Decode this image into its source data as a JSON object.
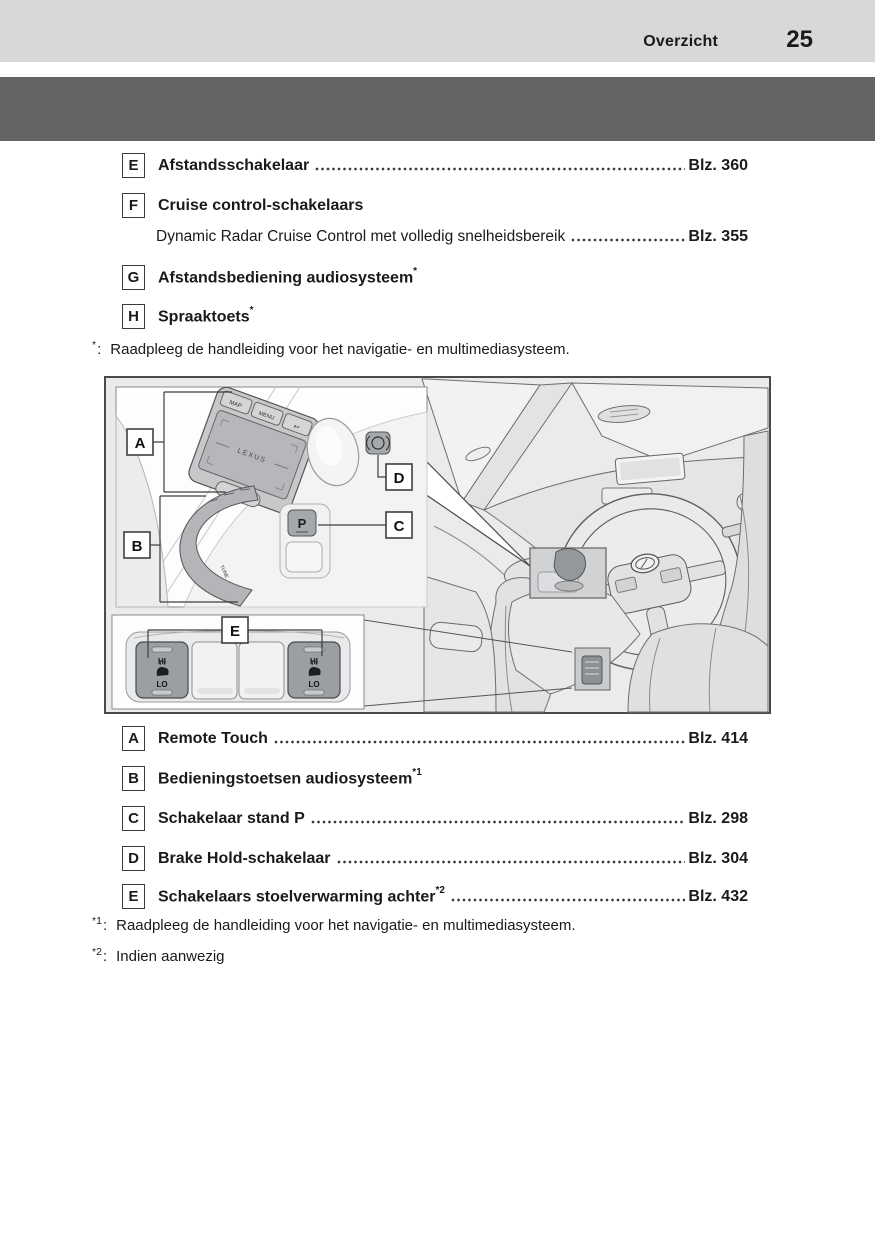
{
  "header": {
    "title": "Overzicht",
    "page_number": "25"
  },
  "top_list": {
    "items": [
      {
        "key": "E",
        "label": "Afstandsschakelaar",
        "page_ref": "Blz. 360"
      },
      {
        "key": "F",
        "label": "Cruise control-schakelaars",
        "sub_label": "Dynamic Radar Cruise Control met volledig snelheidsbereik",
        "sub_page_ref": "Blz. 355"
      },
      {
        "key": "G",
        "label": "Afstandsbediening audiosysteem",
        "superscript": "*"
      },
      {
        "key": "H",
        "label": "Spraaktoets",
        "superscript": "*"
      }
    ]
  },
  "footnote_top": {
    "marker": "*",
    "colon": ":",
    "text": "Raadpleeg de handleiding voor het navigatie- en multimediasysteem."
  },
  "figure": {
    "callouts": {
      "a": "A",
      "b": "B",
      "c": "C",
      "d": "D",
      "e": "E"
    },
    "touchpad": {
      "brand": "LEXUS",
      "key_map": "MAP",
      "key_menu": "MENU",
      "key_back": "↩",
      "key_up": "▲"
    },
    "audio_panel": {
      "label": "TUNE"
    },
    "park_switch": {
      "label": "P"
    },
    "seat_heater": {
      "hi": "HI",
      "lo": "LO"
    }
  },
  "bottom_list": {
    "items": [
      {
        "key": "A",
        "label": "Remote Touch",
        "page_ref": "Blz. 414"
      },
      {
        "key": "B",
        "label": "Bedieningstoetsen audiosysteem",
        "superscript": "*1"
      },
      {
        "key": "C",
        "label": "Schakelaar stand P",
        "page_ref": "Blz. 298"
      },
      {
        "key": "D",
        "label": "Brake Hold-schakelaar",
        "page_ref": "Blz. 304"
      },
      {
        "key": "E",
        "label": "Schakelaars stoelverwarming achter",
        "superscript": "*2",
        "page_ref": "Blz. 432"
      }
    ]
  },
  "footnotes_bottom": [
    {
      "marker": "*1",
      "colon": ":",
      "text": "Raadpleeg de handleiding voor het navigatie- en multimediasysteem."
    },
    {
      "marker": "*2",
      "colon": ":",
      "text": "Indien aanwezig"
    }
  ],
  "colors": {
    "header_bg": "#d8d8d8",
    "banner_bg": "#646464",
    "text": "#1a1a1a",
    "figure_bg": "#ebebed"
  }
}
